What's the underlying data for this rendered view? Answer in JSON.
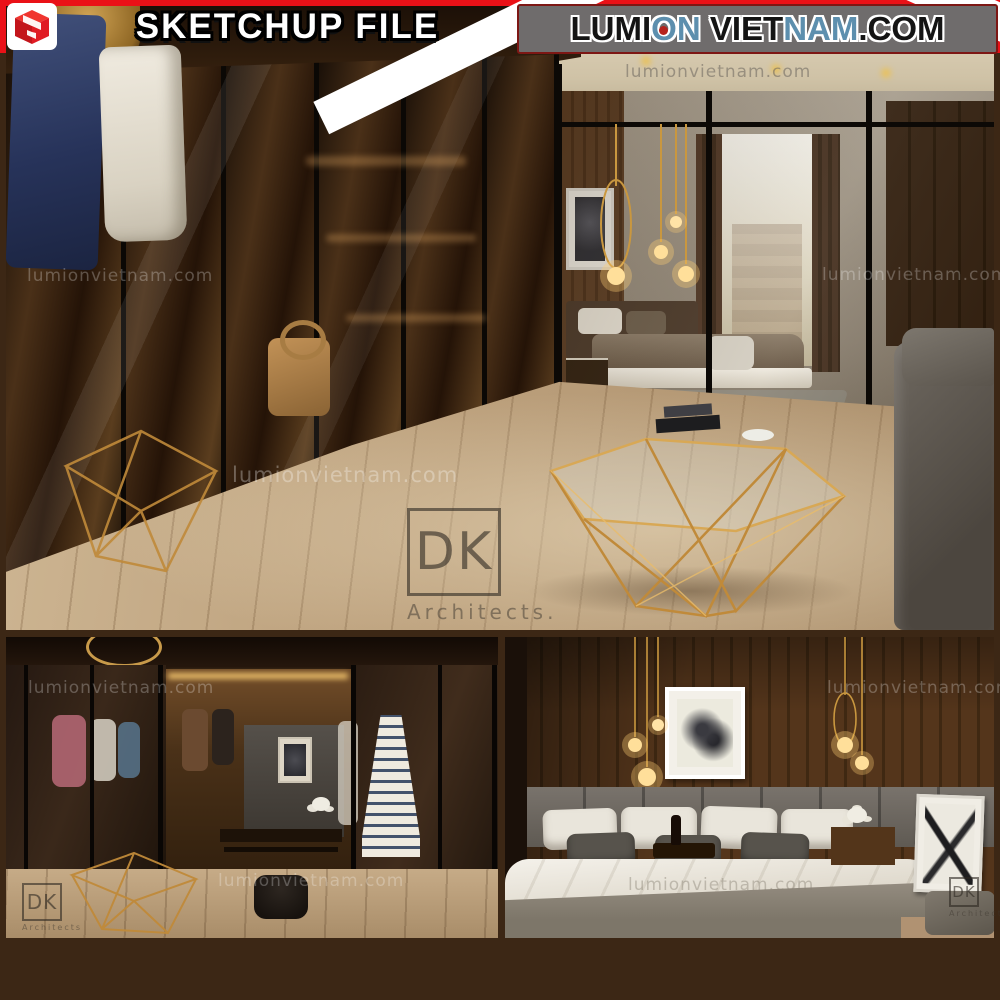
{
  "watermark": {
    "text": "lumionvietnam.com"
  },
  "dk_watermark": {
    "initials": "DK",
    "label": "Architects.",
    "label_small": "Architects"
  },
  "banner": {
    "sketchup_label": "SKETCHUP FILE",
    "site_parts": [
      {
        "text": "LUMI",
        "color": "#141414"
      },
      {
        "text": "O",
        "color": "#5d8fae"
      },
      {
        "text": "N",
        "color": "#5d8fae"
      },
      {
        "text": " VIET",
        "color": "#141414"
      },
      {
        "text": "NAM",
        "color": "#5d8fae"
      },
      {
        "text": ".COM",
        "color": "#141414"
      }
    ]
  },
  "colors": {
    "frame_brown": "#3c2715",
    "banner_red": "#ea1117",
    "banner_gray_box": "#6f6c6c",
    "site_text_dark": "#141414",
    "site_text_blue": "#5d8fae",
    "gold_accent": "#c8913f",
    "sketchup_logo_red": "#e01b24"
  }
}
